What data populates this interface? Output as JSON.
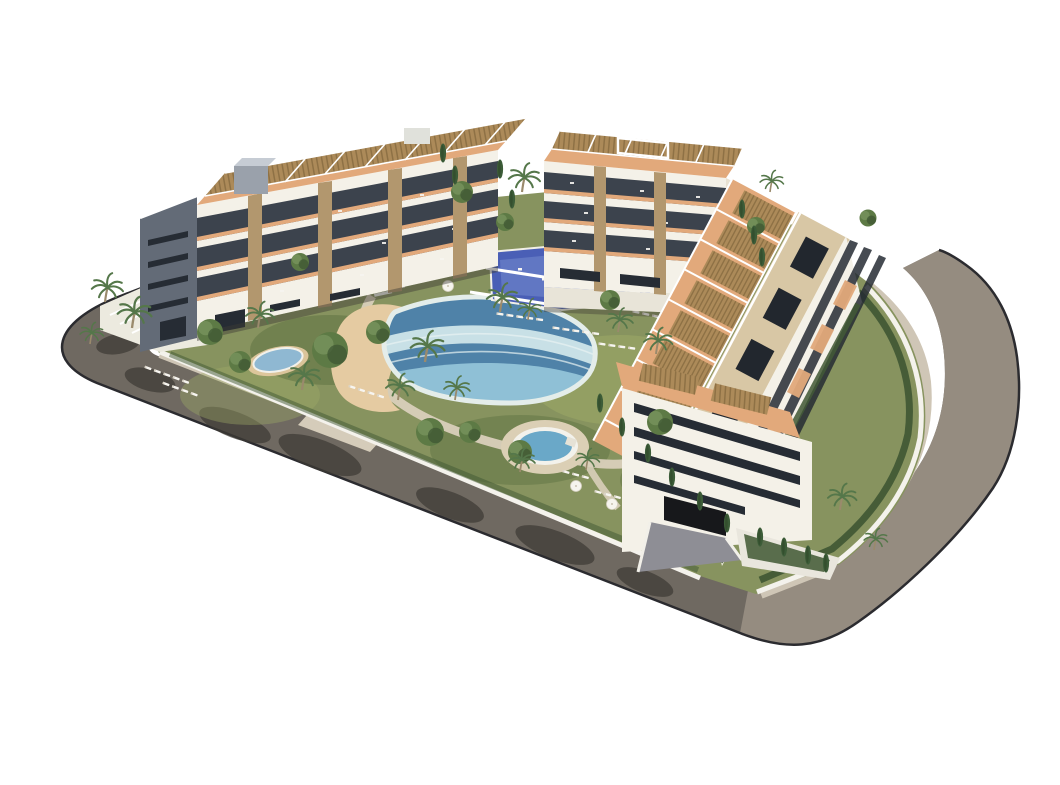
{
  "meta": {
    "domain": "natural-image",
    "subject": "aerial 3D architectural render of a modern white residential apartment complex",
    "setting": "isolated on a plain white studio background",
    "view": "high-angle aerial perspective from the south-west"
  },
  "colors": {
    "background": "#ffffff",
    "road_asphalt": "#958c80",
    "road_shaded": "#6f6961",
    "road_shadow": "#3e3b35",
    "curb_dark": "#2b2b2f",
    "sidewalk": "#cfc6b6",
    "sidewalk_curb": "#ece7db",
    "plot_lawn": "#87935f",
    "lawn_light": "#9da966",
    "lawn_dark": "#5c7040",
    "wall_white": "#f4f2ec",
    "plaza_white": "#eceadf",
    "building_white": "#f4f1e8",
    "building_cream": "#e9e2d2",
    "gable_gray": "#636b77",
    "window_dark": "#262c34",
    "recess_dark": "#3c434d",
    "stone_pillar": "#b2976e",
    "pergola_slat": "#ac8a59",
    "pergola_line": "#6f5832",
    "terrace_floor": "#e2a97b",
    "roof_deck": "#d8c7a5",
    "skylight_dark": "#22272e",
    "pool_deep": "#4f82a8",
    "pool_mid": "#8fc0d6",
    "pool_pale": "#c8e0e6",
    "pool_rim": "#e4edea",
    "sand": "#e5cba2",
    "pond_water": "#8fb8d2",
    "spa_water": "#6aa8c8",
    "spa_deck": "#dbcfb5",
    "deck_blue": "#4a5fb6",
    "deck_blue_light": "#7287cc",
    "path_beige": "#d9cfba",
    "tree_green": "#5d7a45",
    "tree_dark": "#3f5733",
    "cypress_green": "#3c5c38",
    "palm_green": "#55774a",
    "trunk_brown": "#9a8a6c",
    "furniture_white": "#f7f5f0",
    "shadow_soft": "#4a4f42"
  },
  "scene": {
    "buildings": [
      {
        "id": "north-west-block",
        "floors": 4,
        "features": [
          "dark glazed gable end with window slits",
          "white tiered balconies",
          "terracotta terrace floors",
          "stone-clad pillars",
          "rooftop wood-slat pergolas",
          "rooftop stair box"
        ]
      },
      {
        "id": "north-block",
        "floors": 4,
        "features": [
          "white balcony slabs",
          "stone pillars",
          "rooftop pergolas with white frame",
          "cream side wall",
          "garage doors at base"
        ]
      },
      {
        "id": "east-block",
        "floors": 4,
        "features": [
          "long cream flat roof with dark skylights",
          "rows of wood-slat pergola terraces facing the garden",
          "street-facing white facade with ribbon windows",
          "south gable with dark ribbon windows",
          "basement garage ramp",
          "cypress planters"
        ]
      }
    ],
    "amenities": [
      {
        "id": "lagoon-pool",
        "style": "freeform pool with pale shallow shelf and beach entry"
      },
      {
        "id": "sand-beach-area"
      },
      {
        "id": "round-spa-pool"
      },
      {
        "id": "blue-sport-deck",
        "note": "bright blue leisure deck with white furniture"
      },
      {
        "id": "garden-pond"
      },
      {
        "id": "sun-lounger-rows"
      },
      {
        "id": "white-parasols"
      },
      {
        "id": "palm-garden",
        "plants": [
          "palm trees",
          "cypress columns",
          "round canopy trees",
          "hedges"
        ]
      }
    ],
    "road": {
      "type": "perimeter street wrapping the plot with rounded corners",
      "sidewalk": "beige inner sidewalk with white curb",
      "driveway": "beige driveway cut on the south-west side",
      "shadows": "long tree shadows across the shaded south-west lane"
    }
  }
}
